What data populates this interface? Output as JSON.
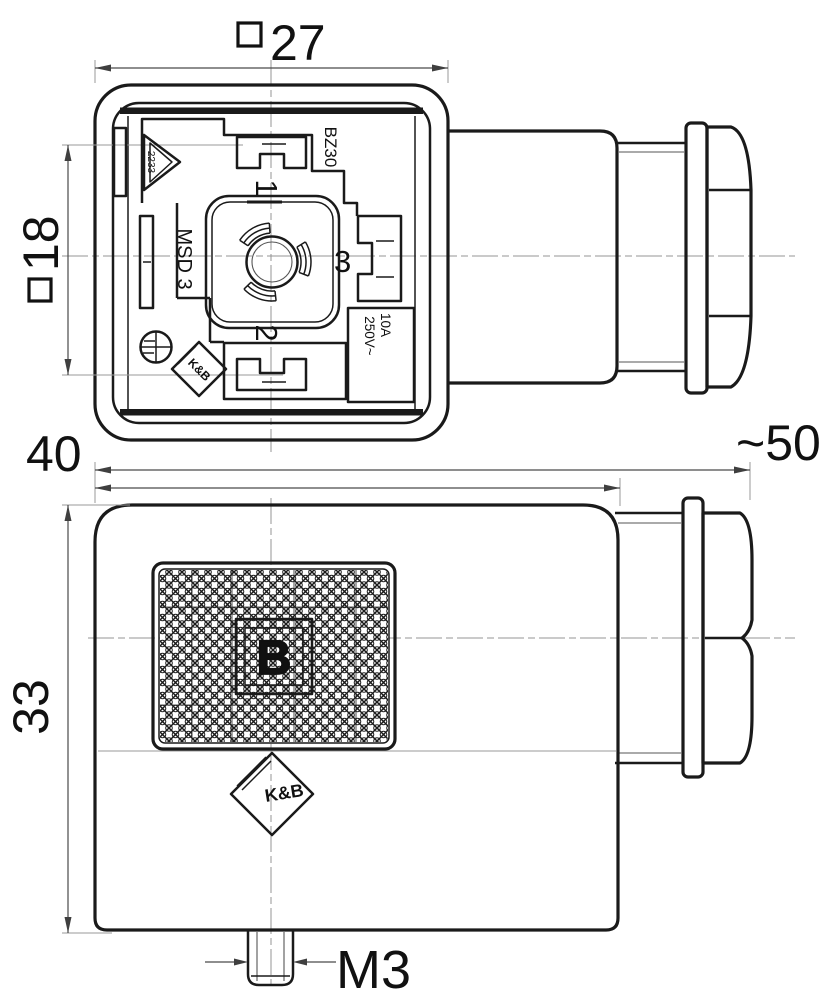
{
  "title": "valve-connector-dimensional-drawing",
  "colors": {
    "line": "#1a1a1a",
    "dimension": "#4a4a4a",
    "centerline": "#949494",
    "background": "#ffffff"
  },
  "front_view": {
    "triangle_label": "2233",
    "type_code": "BZ30",
    "series_label": "MSD 3",
    "pin1": "1",
    "pin2": "2",
    "pin3": "3",
    "rating_current": "10A",
    "rating_voltage": "250V~",
    "logo": "K&B"
  },
  "side_view": {
    "size_letter": "B",
    "logo": "K&B"
  },
  "dimensions": {
    "face_width": {
      "prefix": "□",
      "value": "27"
    },
    "insert_width": {
      "prefix": "□",
      "value": "18"
    },
    "body_depth": {
      "value": "40"
    },
    "overall_length": {
      "value": "~50"
    },
    "body_height": {
      "value": "33"
    },
    "screw_thread": {
      "value": "M3"
    }
  }
}
